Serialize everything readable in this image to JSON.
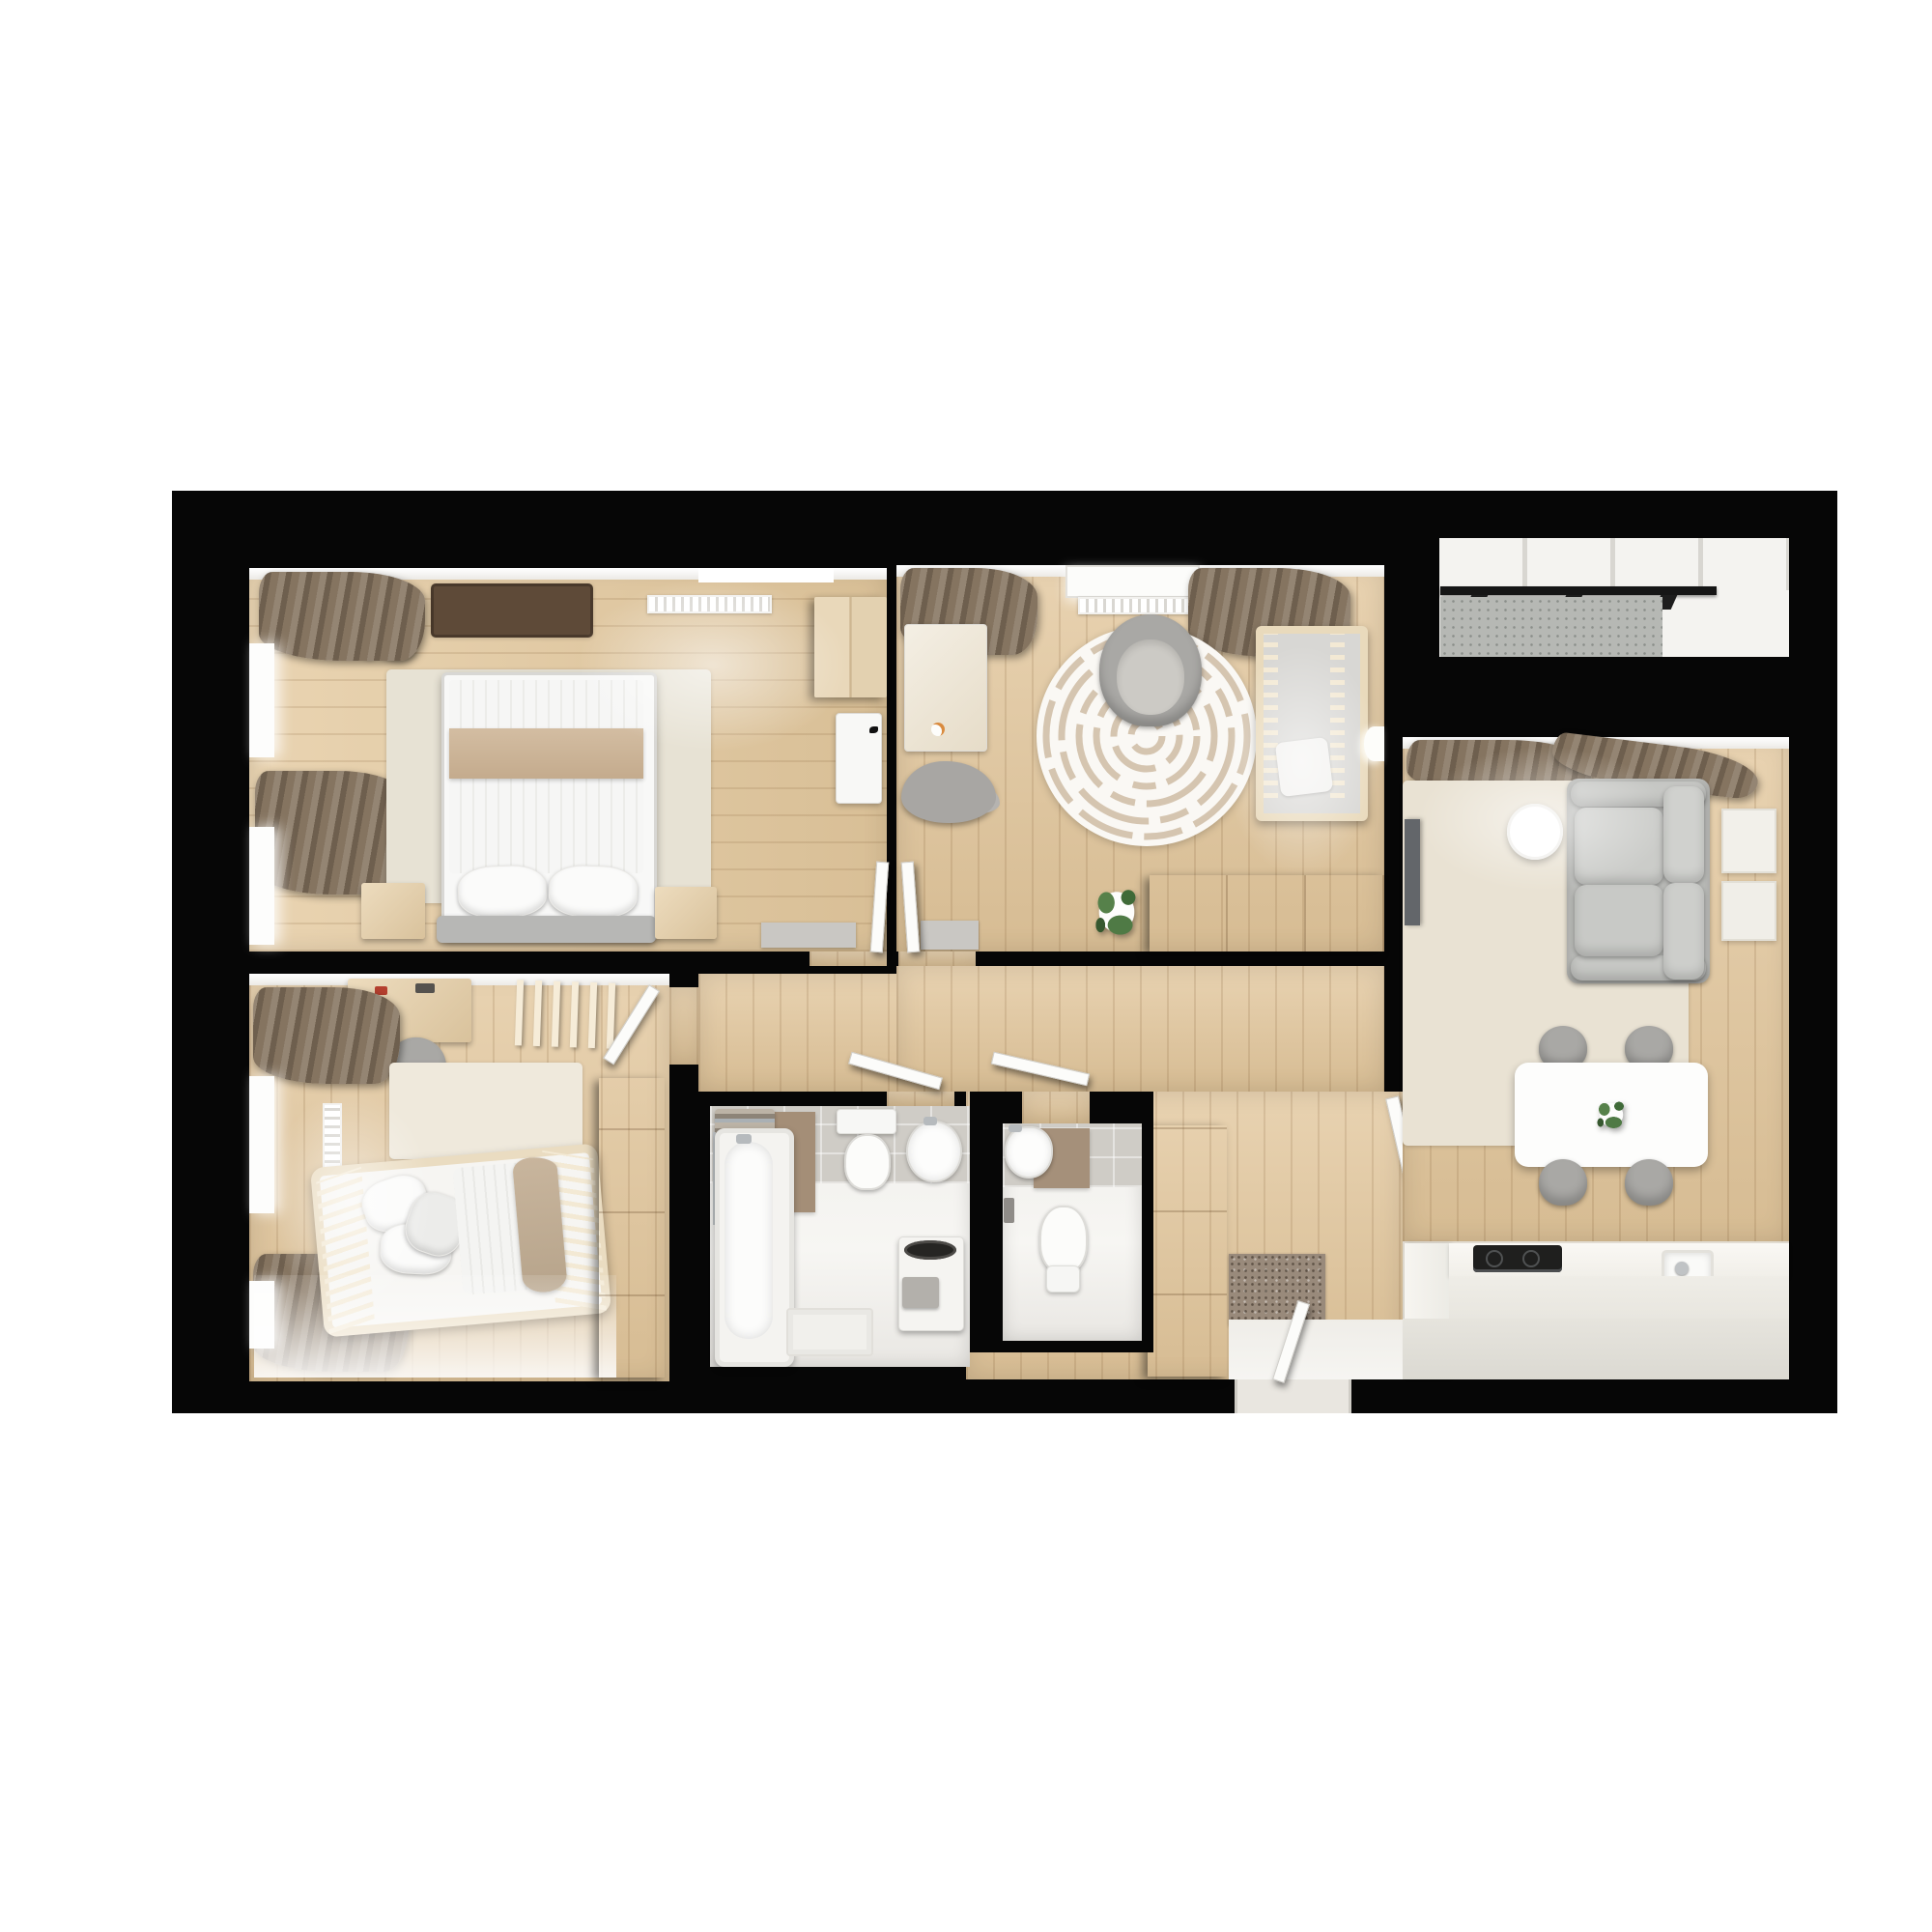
{
  "scene": {
    "kind": "3d-floor-plan-render",
    "view": "top-down cutaway",
    "page_background": "#ffffff",
    "wall_color": "#060606",
    "floor_wood": "#e2c69b",
    "kitchen_floor": "#efe9dd",
    "tile_gray": "#cfccc6",
    "tile_accent_brown": "#a5907a",
    "curtain_brown": "#837463",
    "rug_beige": "#e8e1d2",
    "furniture_wood": "#e6d5b7",
    "sofa_gray": "#c6c7c4",
    "concrete_gray": "#b6b8b4",
    "appliance_black": "#1f1f1e",
    "plant_green": "#4f7a45"
  },
  "rooms": [
    {
      "id": "master-bedroom",
      "label": "Master bedroom",
      "furniture": [
        "double bed",
        "gray headboard",
        "two pillows",
        "beige folded blanket",
        "beige area rug",
        "nightstand left",
        "nightstand right",
        "wardrobe",
        "white dresser",
        "potted plant",
        "dark brown mat",
        "radiator",
        "brown curtains",
        "two windows",
        "gray door mat",
        "white door"
      ]
    },
    {
      "id": "nursery",
      "label": "Nursery",
      "furniture": [
        "crib with slats",
        "round maze-pattern rug",
        "gray armchair",
        "changing dresser",
        "duck toy",
        "gray animal toy",
        "wood sideboard",
        "potted plant",
        "wall lamp",
        "radiator",
        "window sill",
        "brown curtains",
        "gray door mat",
        "white door"
      ]
    },
    {
      "id": "kids-bedroom",
      "label": "Kids bedroom",
      "furniture": [
        "house-frame slatted bed",
        "pillows",
        "white striped duvet",
        "taupe blanket",
        "desk",
        "desk chair",
        "white ladder rack",
        "pale rug",
        "wardrobe",
        "vertical radiator",
        "brown curtains",
        "two windows",
        "white door"
      ]
    },
    {
      "id": "bathroom",
      "label": "Bathroom",
      "furniture": [
        "bathtub",
        "shower pole",
        "towel rail with towels",
        "toilet",
        "pedestal sink",
        "washing machine with dark drum",
        "gray towel",
        "bath mat",
        "gray tile wall",
        "brown tile accent",
        "white door"
      ]
    },
    {
      "id": "wc",
      "label": "WC",
      "furniture": [
        "wall-hung toilet",
        "hand sink",
        "toilet paper holder",
        "gray tile wall",
        "brown tile accent",
        "white door"
      ]
    },
    {
      "id": "hallway",
      "label": "Hallway / entry",
      "furniture": [
        "tall wardrobe cabinet",
        "speckled entry doormat",
        "white entrance threshold",
        "open interior doors"
      ]
    },
    {
      "id": "living-kitchen",
      "label": "Living room with kitchen",
      "furniture": [
        "gray loveseat sofa",
        "round white side table",
        "wall TV",
        "beige rug",
        "two wall art frames",
        "white dining table",
        "four gray chairs",
        "table plant",
        "radiator",
        "brown curtains",
        "kitchen counter",
        "black cooktop",
        "kitchen sink",
        "tall white cabinet"
      ]
    },
    {
      "id": "balcony",
      "label": "Balcony",
      "furniture": [
        "black railing with brackets",
        "concrete deck",
        "white glazing frames"
      ]
    }
  ]
}
